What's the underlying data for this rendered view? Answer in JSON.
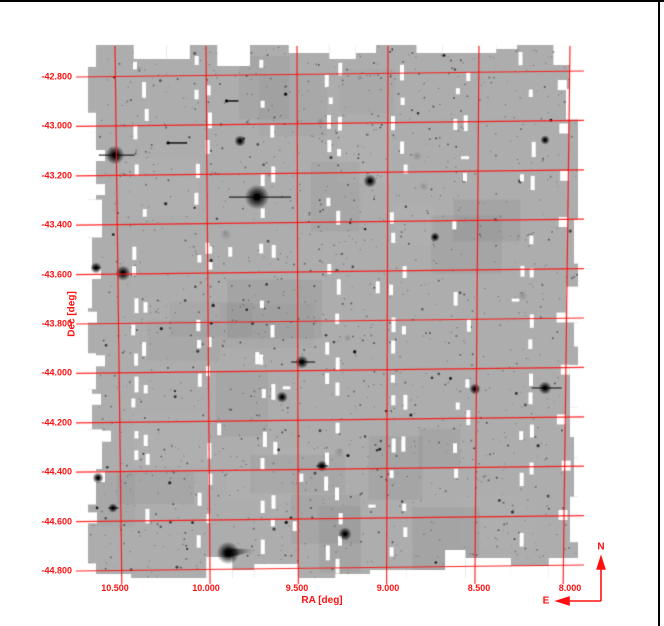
{
  "window": {
    "background": "#ffffff",
    "border_color": "#000000"
  },
  "chart_data": {
    "type": "scatter",
    "title": "",
    "subtitle": "Grayscale astronomical CCD mosaic of a survey field with red celestial coordinate grid overlaid",
    "xlabel": "RA [deg]",
    "ylabel": "Dec [deg]",
    "x_axis_reversed": true,
    "xlim": [
      10.65,
      7.93
    ],
    "ylim": [
      -44.86,
      -42.66
    ],
    "grid": true,
    "x_ticks": [
      10.5,
      10.0,
      9.5,
      9.0,
      8.5,
      8.0
    ],
    "x_tick_labels": [
      "10.500",
      "10.000",
      "9.500",
      "9.000",
      "8.500",
      "8.000"
    ],
    "y_ticks": [
      -42.8,
      -43.0,
      -43.2,
      -43.4,
      -43.6,
      -43.8,
      -44.0,
      -44.2,
      -44.4,
      -44.6,
      -44.8
    ],
    "y_tick_labels": [
      "-42.800",
      "-43.000",
      "-43.200",
      "-43.400",
      "-43.600",
      "-43.800",
      "-44.000",
      "-44.200",
      "-44.400",
      "-44.600",
      "-44.800"
    ],
    "colors": {
      "grid": "#ff1010",
      "labels": "#ff1010",
      "mosaic_gray": "#adadad",
      "gap_white": "#ffffff",
      "source_dark": "#000000",
      "background": "#ffffff",
      "border": "#000000"
    },
    "bright_sources": [
      {
        "ra": 10.5,
        "dec": -43.116,
        "size": 5.0,
        "spike": 36
      },
      {
        "ra": 9.72,
        "dec": -43.286,
        "size": 6.5,
        "spike": 62
      },
      {
        "ra": 9.099,
        "dec": -43.221,
        "size": 3.5,
        "spike": 0
      },
      {
        "ra": 10.456,
        "dec": -43.594,
        "size": 4.0,
        "spike": 0
      },
      {
        "ra": 9.473,
        "dec": -43.954,
        "size": 3.5,
        "spike": 24
      },
      {
        "ra": 9.363,
        "dec": -44.375,
        "size": 3.0,
        "spike": 12
      },
      {
        "ra": 8.137,
        "dec": -44.059,
        "size": 3.5,
        "spike": 30
      },
      {
        "ra": 8.522,
        "dec": -44.063,
        "size": 3.0,
        "spike": 0
      },
      {
        "ra": 9.879,
        "dec": -44.727,
        "size": 6.0,
        "spike": 0,
        "tail": 26
      },
      {
        "ra": 9.236,
        "dec": -44.65,
        "size": 3.5,
        "spike": 0
      },
      {
        "ra": 10.511,
        "dec": -44.545,
        "size": 2.5,
        "spike": 10
      },
      {
        "ra": 10.604,
        "dec": -43.573,
        "size": 3.0,
        "spike": 8
      },
      {
        "ra": 9.582,
        "dec": -44.096,
        "size": 3.0,
        "spike": 0
      },
      {
        "ra": 10.593,
        "dec": -44.423,
        "size": 3.0,
        "spike": 0
      },
      {
        "ra": 8.137,
        "dec": -43.055,
        "size": 2.5,
        "spike": 0
      },
      {
        "ra": 8.742,
        "dec": -43.448,
        "size": 2.5,
        "spike": 0
      },
      {
        "ra": 9.813,
        "dec": -43.059,
        "size": 3.0,
        "spike": 0
      },
      {
        "ra": 10.159,
        "dec": -43.067,
        "size": 0,
        "streak": 20
      },
      {
        "ra": 9.857,
        "dec": -42.897,
        "size": 0,
        "streak": 13
      }
    ],
    "compass": {
      "north_label": "N",
      "east_label": "E"
    }
  }
}
